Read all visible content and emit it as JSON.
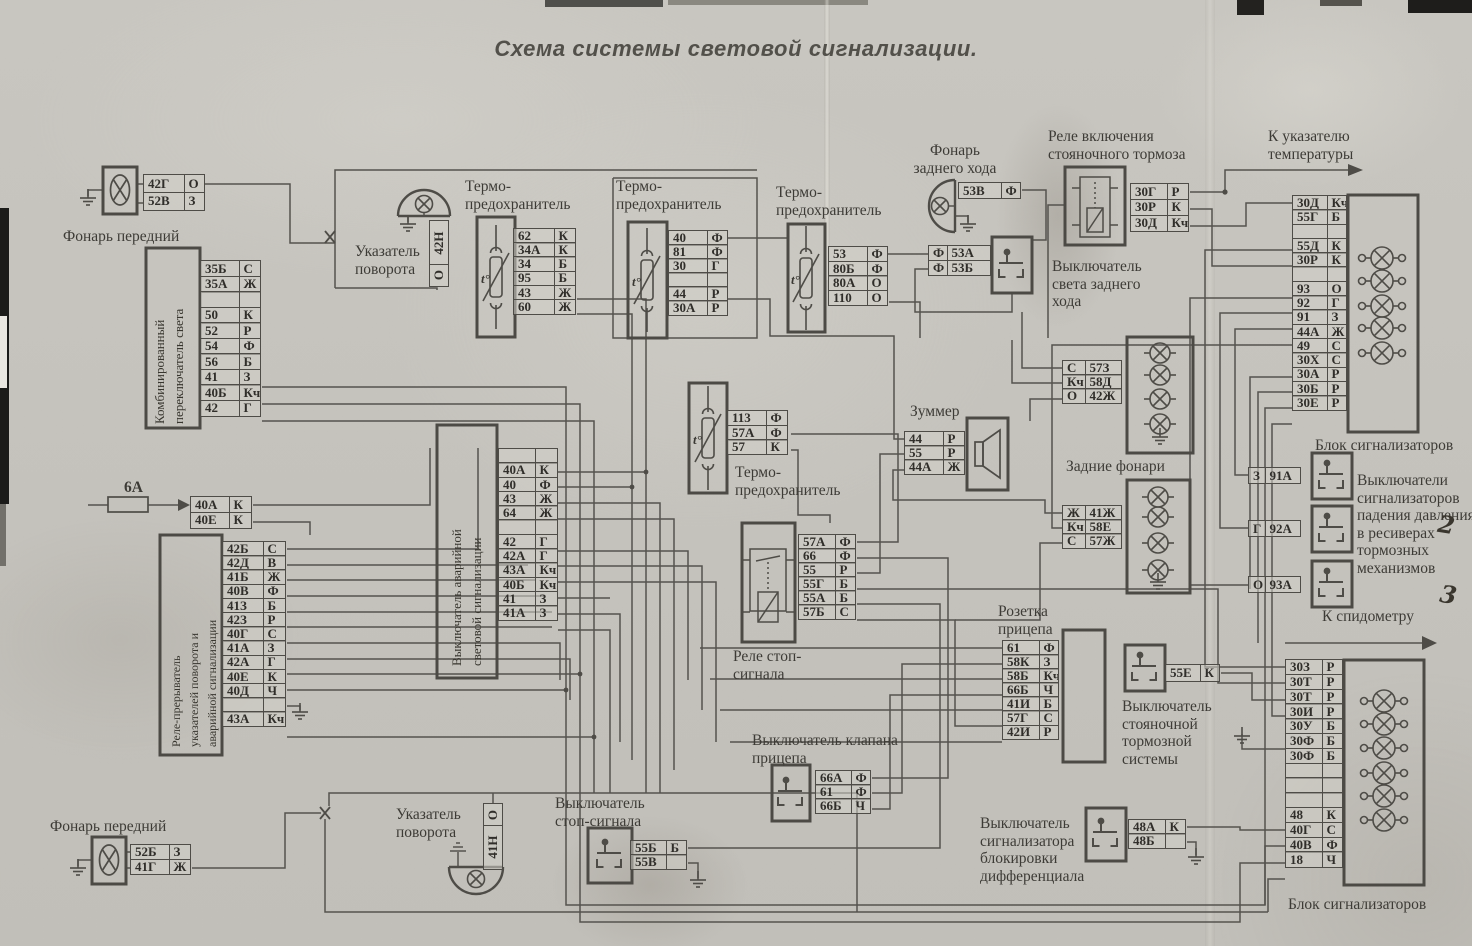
{
  "title": "Схема  системы световой сигнализации.",
  "annotations": {
    "to_temp_gauge": "К указателю температуры",
    "to_speedometer": "К спидометру",
    "handwritten_marks": [
      "2",
      "3"
    ]
  },
  "components": {
    "front_lamp_top": {
      "label": "Фонарь передний",
      "pins": [
        [
          "42Г",
          "О"
        ],
        [
          "52В",
          "З"
        ]
      ]
    },
    "combo_light_switch": {
      "label_lines": [
        "Комбинированный",
        "переключатель света"
      ],
      "pins": [
        [
          "35Б",
          "С"
        ],
        [
          "35А",
          "Ж"
        ],
        null,
        [
          "50",
          "К"
        ],
        [
          "52",
          "Р"
        ],
        [
          "54",
          "Ф"
        ],
        [
          "56",
          "Б"
        ],
        [
          "41",
          "З"
        ],
        [
          "40Б",
          "Кч"
        ],
        [
          "42",
          "Г"
        ]
      ]
    },
    "turn_indicator_top": {
      "label": "Указатель поворота",
      "pins": [
        [
          "42Н",
          "О"
        ]
      ]
    },
    "thermal_fuse_1": {
      "label": "Термо-предохранитель",
      "pins": [
        [
          "62",
          "К"
        ],
        [
          "34А",
          "К"
        ],
        [
          "34",
          "Б"
        ],
        [
          "95",
          "Б"
        ],
        [
          "43",
          "Ж"
        ],
        [
          "60",
          "Ж"
        ]
      ]
    },
    "thermal_fuse_2": {
      "label": "Термо-предохранитель",
      "pins": [
        [
          "40",
          "Ф"
        ],
        [
          "81",
          "Ф"
        ],
        [
          "30",
          "Г"
        ],
        null,
        [
          "44",
          "Р"
        ],
        [
          "30А",
          "Р"
        ]
      ]
    },
    "thermal_fuse_3": {
      "label": "Термо-предохранитель",
      "pins": [
        [
          "53",
          "Ф"
        ],
        [
          "80Б",
          "Ф"
        ],
        [
          "80А",
          "О"
        ],
        [
          "110",
          "О"
        ]
      ]
    },
    "reverse_lamp": {
      "label": "Фонарь заднего хода",
      "pins": [
        [
          "53В",
          "Ф"
        ]
      ]
    },
    "reverse_light_switch": {
      "label": "Выключатель света заднего хода",
      "pins": [
        [
          "Ф",
          "53А"
        ],
        [
          "Ф",
          "53Б"
        ]
      ]
    },
    "parking_brake_relay": {
      "label": "Реле включения стояночного тормоза",
      "pins": [
        [
          "30Г",
          "Р"
        ],
        [
          "30Р",
          "К"
        ],
        [
          "30Д",
          "Кч"
        ]
      ]
    },
    "signal_block_top": {
      "label": "Блок сигнализаторов",
      "pins": [
        [
          "30Д",
          "Кч"
        ],
        [
          "55Г",
          "Б"
        ],
        null,
        [
          "55Д",
          "К"
        ],
        [
          "30Р",
          "К"
        ],
        null,
        [
          "93",
          "О"
        ],
        [
          "92",
          "Г"
        ],
        [
          "91",
          "З"
        ],
        [
          "44А",
          "Ж"
        ],
        [
          "49",
          "С"
        ],
        [
          "30Х",
          "С"
        ],
        [
          "30А",
          "Р"
        ],
        [
          "30Б",
          "Р"
        ],
        [
          "30Е",
          "Р"
        ]
      ]
    },
    "pressure_switches": {
      "label": "Выключатели сигнализаторов падения давления в ресиверах тормозных механизмов",
      "pins": [
        [
          "З",
          "91А"
        ],
        [
          "Г",
          "92А"
        ],
        [
          "О",
          "93А"
        ]
      ]
    },
    "mid_thermal_fuse": {
      "label": "Термо-предохранитель",
      "pins": [
        [
          "113",
          "Ф"
        ],
        [
          "57А",
          "Ф"
        ],
        [
          "57",
          "К"
        ]
      ]
    },
    "buzzer": {
      "label": "Зуммер",
      "pins": [
        [
          "44",
          "Р"
        ],
        [
          "55",
          "Р"
        ],
        [
          "44А",
          "Ж"
        ]
      ]
    },
    "rear_lamps_upper": {
      "pins": [
        [
          "С",
          "57З"
        ],
        [
          "Кч",
          "58Д"
        ],
        [
          "О",
          "42Ж"
        ]
      ]
    },
    "rear_lamps": {
      "label": "Задние фонари",
      "pins": [
        [
          "Ж",
          "41Ж"
        ],
        [
          "Кч",
          "58Е"
        ],
        [
          "С",
          "57Ж"
        ]
      ]
    },
    "hazard_switch": {
      "label_lines": [
        "Выключатель аварийной",
        "световой сигнализации"
      ],
      "pins": [
        null,
        [
          "40А",
          "К"
        ],
        [
          "40",
          "Ф"
        ],
        [
          "43",
          "Ж"
        ],
        [
          "64",
          "Ж"
        ],
        null,
        [
          "42",
          "Г"
        ],
        [
          "42А",
          "Г"
        ],
        [
          "43А",
          "Кч"
        ],
        [
          "40Б",
          "Кч"
        ],
        [
          "41",
          "З"
        ],
        [
          "41А",
          "З"
        ]
      ]
    },
    "fuse_6a": {
      "label": "6А",
      "pins": [
        [
          "40А",
          "К"
        ],
        [
          "40Е",
          "К"
        ]
      ]
    },
    "flasher_relay": {
      "label_lines": [
        "Реле-прерыватель",
        "указателей поворота и",
        "аварийной сигнализации"
      ],
      "pins": [
        [
          "42Б",
          "С"
        ],
        [
          "42Д",
          "В"
        ],
        [
          "41Б",
          "Ж"
        ],
        [
          "40В",
          "Ф"
        ],
        [
          "41З",
          "Б"
        ],
        [
          "42З",
          "Р"
        ],
        [
          "40Г",
          "С"
        ],
        [
          "41А",
          "З"
        ],
        [
          "42А",
          "Г"
        ],
        [
          "40Е",
          "К"
        ],
        [
          "40Д",
          "Ч"
        ],
        null,
        [
          "43А",
          "Кч"
        ]
      ]
    },
    "stop_signal_relay": {
      "label": "Реле стоп-сигнала",
      "pins": [
        [
          "57А",
          "Ф"
        ],
        [
          "66",
          "Ф"
        ],
        [
          "55",
          "Р"
        ],
        [
          "55Г",
          "Б"
        ],
        [
          "55А",
          "Б"
        ],
        [
          "57Б",
          "С"
        ]
      ]
    },
    "trailer_socket": {
      "label": "Розетка прицепа",
      "pins": [
        [
          "61",
          "Ф"
        ],
        [
          "58К",
          "З"
        ],
        [
          "58Б",
          "Кч"
        ],
        [
          "66Б",
          "Ч"
        ],
        [
          "41И",
          "Б"
        ],
        [
          "57Г",
          "С"
        ],
        [
          "42И",
          "Р"
        ]
      ]
    },
    "parking_brake_switch": {
      "label": "Выключатель стояночной тормозной системы",
      "pins": [
        [
          "55Е",
          "К"
        ]
      ]
    },
    "trailer_valve_switch": {
      "label": "Выключатель клапана прицепа",
      "pins": [
        [
          "66А",
          "Ф"
        ],
        [
          "61",
          "Ф"
        ],
        [
          "66Б",
          "Ч"
        ]
      ]
    },
    "stop_signal_switch": {
      "label": "Выключатель стоп-сигнала",
      "pins": [
        [
          "55Б",
          "Б"
        ],
        [
          "55В",
          ""
        ]
      ]
    },
    "diff_lock_switch": {
      "label": "Выключатель сигнализатора блокировки дифференциала",
      "pins": [
        [
          "48А",
          "К"
        ],
        [
          "48Б",
          ""
        ]
      ]
    },
    "signal_block_bottom": {
      "label": "Блок сигнализаторов",
      "pins": [
        [
          "30З",
          "Р"
        ],
        [
          "30Т",
          "Р"
        ],
        [
          "30Т",
          "Р"
        ],
        [
          "30И",
          "Р"
        ],
        [
          "30У",
          "Б"
        ],
        [
          "30Ф",
          "Б"
        ],
        [
          "30Ф",
          "Б"
        ],
        null,
        null,
        null,
        [
          "48",
          "К"
        ],
        [
          "40Г",
          "С"
        ],
        [
          "40В",
          "Ф"
        ],
        [
          "18",
          "Ч"
        ]
      ]
    },
    "front_lamp_bottom": {
      "label": "Фонарь передний",
      "pins": [
        [
          "52Б",
          "З"
        ],
        [
          "41Г",
          "Ж"
        ]
      ]
    },
    "turn_indicator_bottom": {
      "label": "Указатель поворота",
      "pins": [
        [
          "О",
          "41Н"
        ]
      ]
    }
  }
}
